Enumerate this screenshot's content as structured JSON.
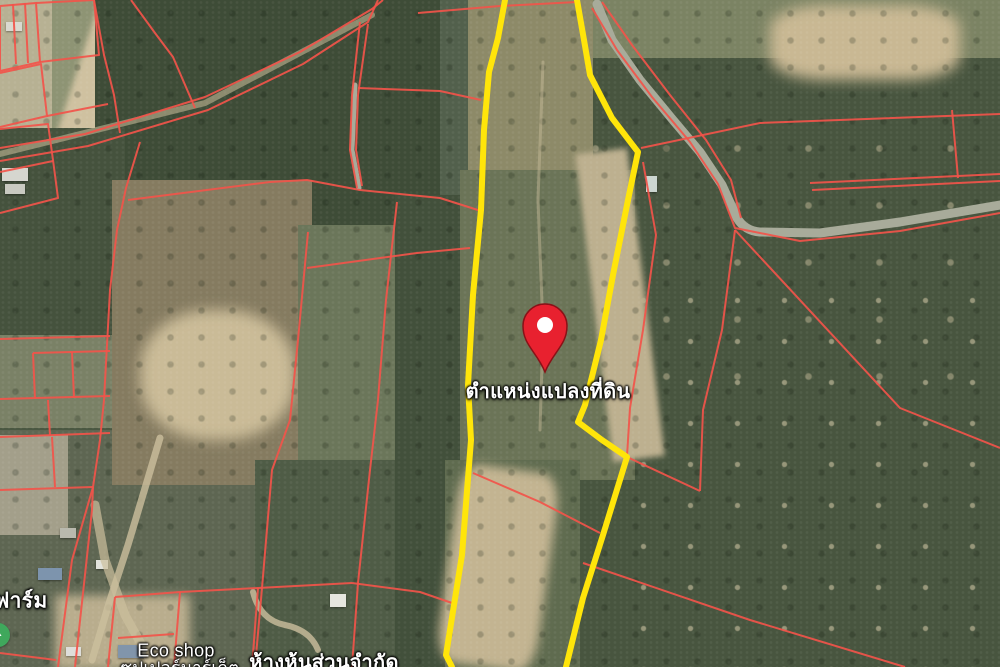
{
  "map": {
    "colors": {
      "base": "#52604c",
      "parcel_line": "#f2544a",
      "selected_outline": "#ffe50a",
      "road": "#a8ab9a",
      "track": "#ccbf9d",
      "pin_fill": "#e8212f",
      "pin_stroke": "#8a1117",
      "pin_hole": "#ffffff",
      "poi_green": "#3fa85c",
      "label_text": "#ffffff"
    },
    "labels": [
      {
        "id": "parcel-location",
        "text": "ตำแหน่งแปลงที่ดิน",
        "x": 548,
        "y": 391,
        "size": 20,
        "bold": true
      },
      {
        "id": "farm",
        "text": "ฟาร์ม",
        "x": 21,
        "y": 601,
        "size": 21,
        "bold": true
      },
      {
        "id": "eco-shop",
        "text": "Eco shop",
        "x": 176,
        "y": 651,
        "size": 18,
        "bold": false
      },
      {
        "id": "supermarket",
        "text": "ซุปเปอร์มาร์เก็ต",
        "x": 180,
        "y": 668,
        "size": 17,
        "bold": false
      },
      {
        "id": "partnership",
        "text": "ห้างหุ้นส่วนจำกัด",
        "x": 324,
        "y": 662,
        "size": 20,
        "bold": true
      }
    ],
    "pin": {
      "tip_x": 545,
      "tip_y": 372,
      "radius": 22,
      "hole_radius": 8
    },
    "poi": {
      "cx": -2,
      "cy": 635,
      "r": 12
    },
    "selected_parcel": {
      "left_edge": [
        [
          505,
          0
        ],
        [
          498,
          38
        ],
        [
          489,
          72
        ],
        [
          484,
          130
        ],
        [
          481,
          210
        ],
        [
          473,
          295
        ],
        [
          468,
          385
        ],
        [
          471,
          440
        ],
        [
          462,
          555
        ],
        [
          446,
          655
        ],
        [
          452,
          667
        ]
      ],
      "right_edge": [
        [
          577,
          0
        ],
        [
          584,
          40
        ],
        [
          590,
          75
        ],
        [
          612,
          118
        ],
        [
          638,
          152
        ],
        [
          628,
          200
        ],
        [
          613,
          275
        ],
        [
          601,
          340
        ],
        [
          585,
          405
        ],
        [
          578,
          422
        ],
        [
          602,
          440
        ],
        [
          627,
          457
        ],
        [
          603,
          535
        ],
        [
          583,
          598
        ],
        [
          566,
          667
        ]
      ],
      "stroke_width": 6
    },
    "roads": [
      {
        "d": "M597,4 L612,40 L640,80 L673,120 L700,152 L722,185 L737,218 Q745,231 760,232 L820,233 L900,222 L1000,205",
        "w": 9
      },
      {
        "d": "M355,85 L352,150 L359,188",
        "w": 5
      }
    ],
    "tracks": [
      {
        "d": "M0,154 L205,103 L372,15",
        "w": 6,
        "o": 0.55
      },
      {
        "d": "M160,438 L128,545 L110,600 L92,660",
        "w": 7,
        "o": 0.8
      },
      {
        "d": "M95,505 L105,560 L125,615 L150,660",
        "w": 9,
        "o": 0.7
      },
      {
        "d": "M543,62 L538,200 L543,330 L540,430",
        "w": 3,
        "o": 0.45
      },
      {
        "d": "M253,592 Q260,620 285,625 T318,650",
        "w": 6,
        "o": 0.8
      }
    ],
    "red_lines": [
      [
        [
          0,
          6
        ],
        [
          36,
          3
        ],
        [
          40,
          62
        ],
        [
          0,
          71
        ],
        [
          0,
          6
        ]
      ],
      [
        [
          13,
          4
        ],
        [
          16,
          64
        ]
      ],
      [
        [
          25,
          3
        ],
        [
          28,
          63
        ]
      ],
      [
        [
          0,
          73
        ],
        [
          41,
          64
        ],
        [
          47,
          116
        ],
        [
          0,
          127
        ]
      ],
      [
        [
          36,
          3
        ],
        [
          94,
          0
        ]
      ],
      [
        [
          94,
          0
        ],
        [
          99,
          55
        ],
        [
          40,
          62
        ]
      ],
      [
        [
          47,
          116
        ],
        [
          108,
          104
        ]
      ],
      [
        [
          0,
          129
        ],
        [
          48,
          124
        ],
        [
          53,
          160
        ],
        [
          58,
          198
        ],
        [
          0,
          213
        ]
      ],
      [
        [
          0,
          172
        ],
        [
          53,
          161
        ]
      ],
      [
        [
          94,
          0
        ],
        [
          104,
          55
        ],
        [
          114,
          95
        ],
        [
          120,
          133
        ]
      ],
      [
        [
          0,
          148
        ],
        [
          85,
          134
        ],
        [
          205,
          97
        ],
        [
          300,
          52
        ],
        [
          372,
          9
        ],
        [
          383,
          0
        ]
      ],
      [
        [
          0,
          161
        ],
        [
          88,
          146
        ],
        [
          208,
          110
        ],
        [
          303,
          64
        ],
        [
          368,
          22
        ],
        [
          378,
          0
        ]
      ],
      [
        [
          360,
          22
        ],
        [
          352,
          95
        ],
        [
          350,
          150
        ],
        [
          357,
          188
        ]
      ],
      [
        [
          368,
          24
        ],
        [
          358,
          95
        ],
        [
          356,
          150
        ],
        [
          362,
          186
        ]
      ],
      [
        [
          358,
          88
        ],
        [
          440,
          91
        ],
        [
          481,
          100
        ]
      ],
      [
        [
          128,
          200
        ],
        [
          270,
          182
        ],
        [
          307,
          180
        ],
        [
          360,
          190
        ],
        [
          440,
          198
        ],
        [
          481,
          211
        ]
      ],
      [
        [
          131,
          0
        ],
        [
          155,
          33
        ],
        [
          173,
          57
        ],
        [
          195,
          108
        ]
      ],
      [
        [
          140,
          142
        ],
        [
          126,
          188
        ],
        [
          117,
          230
        ],
        [
          110,
          290
        ],
        [
          104,
          400
        ],
        [
          100,
          440
        ],
        [
          93,
          487
        ],
        [
          92,
          510
        ],
        [
          75,
          667
        ]
      ],
      [
        [
          93,
          487
        ],
        [
          72,
          560
        ],
        [
          58,
          667
        ]
      ],
      [
        [
          0,
          339
        ],
        [
          110,
          336
        ]
      ],
      [
        [
          33,
          353
        ],
        [
          110,
          351
        ]
      ],
      [
        [
          33,
          353
        ],
        [
          35,
          399
        ]
      ],
      [
        [
          72,
          352
        ],
        [
          74,
          398
        ]
      ],
      [
        [
          0,
          399
        ],
        [
          110,
          396
        ]
      ],
      [
        [
          48,
          400
        ],
        [
          50,
          436
        ]
      ],
      [
        [
          0,
          437
        ],
        [
          110,
          433
        ]
      ],
      [
        [
          52,
          437
        ],
        [
          55,
          487
        ]
      ],
      [
        [
          0,
          490
        ],
        [
          93,
          487
        ]
      ],
      [
        [
          308,
          232
        ],
        [
          298,
          340
        ],
        [
          290,
          420
        ],
        [
          272,
          470
        ],
        [
          262,
          588
        ],
        [
          255,
          667
        ]
      ],
      [
        [
          397,
          202
        ],
        [
          386,
          300
        ],
        [
          378,
          400
        ],
        [
          370,
          470
        ],
        [
          358,
          583
        ],
        [
          352,
          667
        ]
      ],
      [
        [
          307,
          268
        ],
        [
          417,
          253
        ],
        [
          470,
          248
        ]
      ],
      [
        [
          115,
          597
        ],
        [
          180,
          592
        ],
        [
          258,
          588
        ],
        [
          352,
          583
        ]
      ],
      [
        [
          115,
          597
        ],
        [
          108,
          667
        ]
      ],
      [
        [
          180,
          592
        ],
        [
          174,
          667
        ]
      ],
      [
        [
          258,
          588
        ],
        [
          252,
          667
        ]
      ],
      [
        [
          118,
          638
        ],
        [
          174,
          634
        ]
      ],
      [
        [
          352,
          583
        ],
        [
          420,
          592
        ],
        [
          452,
          603
        ]
      ],
      [
        [
          0,
          653
        ],
        [
          56,
          660
        ]
      ],
      [
        [
          418,
          13
        ],
        [
          500,
          6
        ],
        [
          577,
          2
        ]
      ],
      [
        [
          641,
          148
        ],
        [
          760,
          123
        ],
        [
          1000,
          114
        ]
      ],
      [
        [
          602,
          2
        ],
        [
          632,
          45
        ],
        [
          670,
          95
        ],
        [
          706,
          140
        ],
        [
          731,
          180
        ],
        [
          741,
          218
        ]
      ],
      [
        [
          592,
          8
        ],
        [
          617,
          50
        ],
        [
          652,
          97
        ],
        [
          690,
          142
        ],
        [
          718,
          184
        ],
        [
          735,
          228
        ],
        [
          800,
          241
        ],
        [
          900,
          231
        ],
        [
          1000,
          213
        ]
      ],
      [
        [
          810,
          183
        ],
        [
          1000,
          174
        ]
      ],
      [
        [
          812,
          190
        ],
        [
          1000,
          181
        ]
      ],
      [
        [
          735,
          230
        ],
        [
          722,
          330
        ],
        [
          703,
          410
        ],
        [
          700,
          491
        ]
      ],
      [
        [
          735,
          230
        ],
        [
          900,
          408
        ],
        [
          1000,
          448
        ]
      ],
      [
        [
          643,
          162
        ],
        [
          656,
          235
        ],
        [
          643,
          330
        ],
        [
          630,
          408
        ],
        [
          627,
          456
        ]
      ],
      [
        [
          627,
          457
        ],
        [
          700,
          491
        ]
      ],
      [
        [
          583,
          563
        ],
        [
          750,
          620
        ],
        [
          905,
          667
        ]
      ],
      [
        [
          473,
          473
        ],
        [
          540,
          502
        ],
        [
          600,
          533
        ]
      ],
      [
        [
          952,
          110
        ],
        [
          958,
          178
        ]
      ]
    ]
  }
}
